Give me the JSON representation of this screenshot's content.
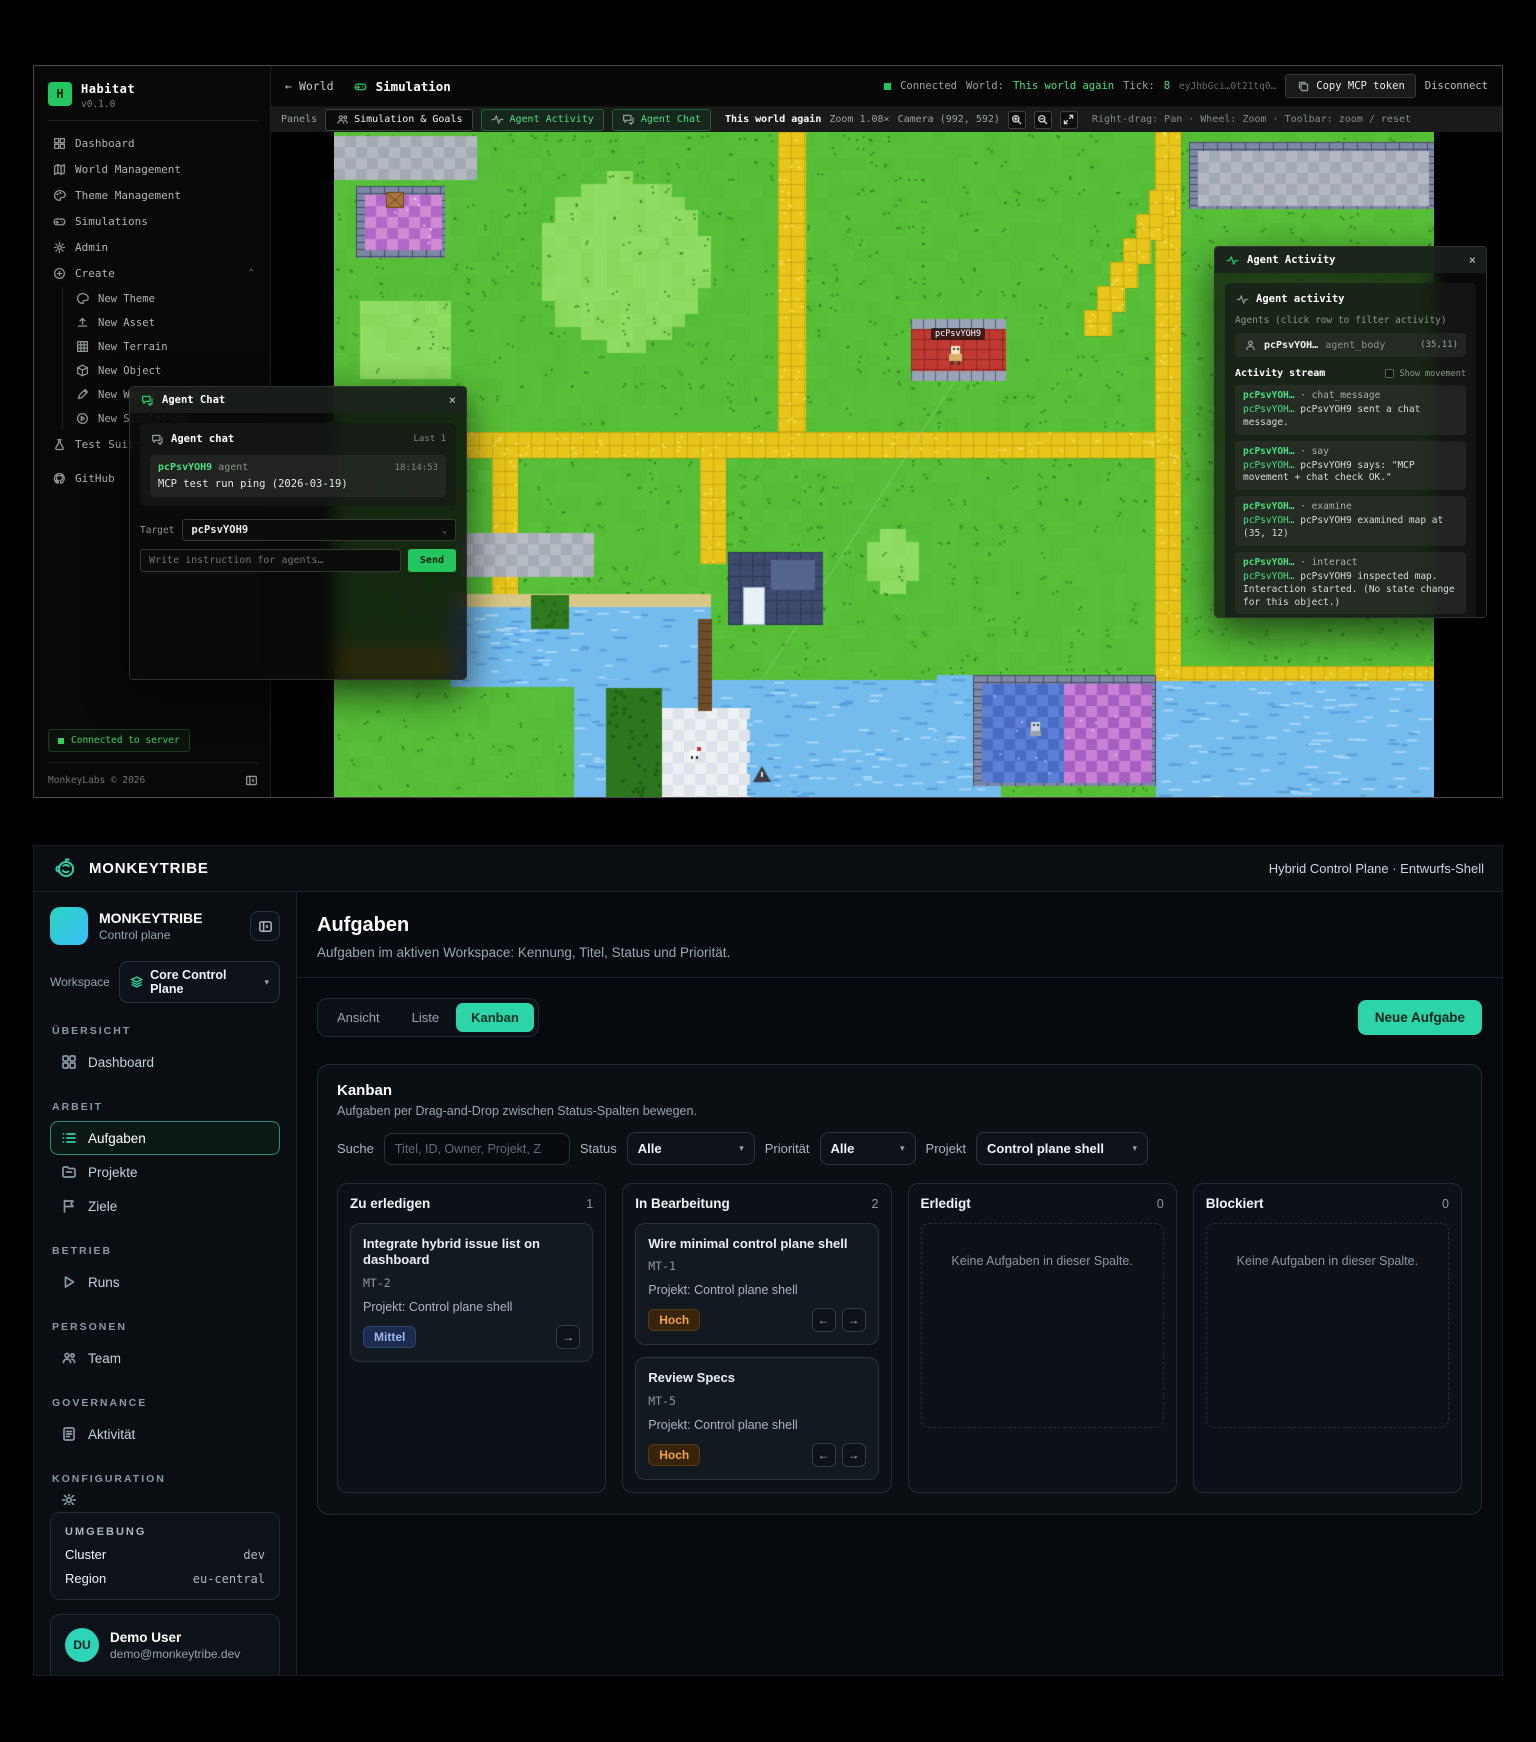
{
  "habitat": {
    "accent": "#22c55e",
    "brand": {
      "initial": "H",
      "name": "Habitat",
      "version": "v0.1.0"
    },
    "sidebar": {
      "items": [
        {
          "label": "Dashboard"
        },
        {
          "label": "World Management"
        },
        {
          "label": "Theme Management"
        },
        {
          "label": "Simulations"
        },
        {
          "label": "Admin"
        }
      ],
      "create_label": "Create",
      "create_items": [
        {
          "label": "New Theme"
        },
        {
          "label": "New Asset"
        },
        {
          "label": "New Terrain"
        },
        {
          "label": "New Object"
        },
        {
          "label": "New World (Editor)"
        },
        {
          "label": "New Simulation"
        }
      ],
      "test_suite_label": "Test Suite",
      "github_label": "GitHub",
      "connected_chip": "Connected to server",
      "footer": "MonkeyLabs © 2026"
    },
    "header": {
      "back_label": "World",
      "title": "Simulation",
      "status": "Connected",
      "world_key": "World:",
      "world_value": "This world again",
      "tick_key": "Tick:",
      "tick_value": "8",
      "token": "eyJhbGci…0t21tq0…",
      "copy_button": "Copy MCP token",
      "disconnect_button": "Disconnect"
    },
    "toolbar": {
      "panels_label": "Panels",
      "sim_goals": "Simulation & Goals",
      "agent_activity": "Agent Activity",
      "agent_chat": "Agent Chat",
      "world_name": "This world again",
      "zoom": "Zoom 1.08×",
      "camera": "Camera (992, 592)",
      "hint": "Right-drag: Pan · Wheel: Zoom · Toolbar: zoom / reset"
    },
    "map": {
      "agent_label": "pcPsvYOH9"
    },
    "chat": {
      "window_title": "Agent Chat",
      "panel_title": "Agent chat",
      "last_label": "Last 1",
      "message": {
        "author": "pcPsvYOH9",
        "role": "agent",
        "time": "18:14:53",
        "text": "MCP test run ping (2026-03-19)"
      },
      "target_label": "Target",
      "target_value": "pcPsvYOH9",
      "input_placeholder": "Write instruction for agents…",
      "send_label": "Send"
    },
    "activity": {
      "window_title": "Agent Activity",
      "panel_title": "Agent activity",
      "agents_hint": "Agents (click row to filter activity)",
      "agent_row": {
        "name": "pcPsvYOH…",
        "kind": "agent_body",
        "pos": "(35,11)"
      },
      "stream_label": "Activity stream",
      "show_movement": "Show movement",
      "entries": [
        {
          "name": "pcPsvYOH…",
          "action": "· chat_message",
          "by": "pcPsvYOH…",
          "text": "pcPsvYOH9 sent a chat message."
        },
        {
          "name": "pcPsvYOH…",
          "action": "· say",
          "by": "pcPsvYOH…",
          "text": "pcPsvYOH9 says: \"MCP movement + chat check OK.\""
        },
        {
          "name": "pcPsvYOH…",
          "action": "· examine",
          "by": "pcPsvYOH…",
          "text": "pcPsvYOH9 examined map at (35, 12)"
        },
        {
          "name": "pcPsvYOH…",
          "action": "· interact",
          "by": "pcPsvYOH…",
          "text": "pcPsvYOH9 inspected map. Interaction started. (No state change for this object.)"
        }
      ]
    }
  },
  "monkeytribe": {
    "accent": "#2dd4a8",
    "topbar": {
      "brand": "MONKEYTRIBE",
      "context": "Hybrid Control Plane · Entwurfs-Shell"
    },
    "sidebar": {
      "org_name": "MONKEYTRIBE",
      "org_sub": "Control plane",
      "workspace_label": "Workspace",
      "workspace_value": "Core Control Plane",
      "sections": {
        "uebersicht": "ÜBERSICHT",
        "arbeit": "ARBEIT",
        "betrieb": "BETRIEB",
        "personen": "PERSONEN",
        "governance": "GOVERNANCE",
        "konfiguration": "KONFIGURATION"
      },
      "nav": {
        "dashboard": "Dashboard",
        "aufgaben": "Aufgaben",
        "projekte": "Projekte",
        "ziele": "Ziele",
        "runs": "Runs",
        "team": "Team",
        "aktivitaet": "Aktivität"
      },
      "env": {
        "title": "UMGEBUNG",
        "cluster_label": "Cluster",
        "cluster_value": "dev",
        "region_label": "Region",
        "region_value": "eu-central"
      },
      "user": {
        "initials": "DU",
        "name": "Demo User",
        "email": "demo@monkeytribe.dev",
        "scheme_label": "Farbschema",
        "scheme_value": "DUNKEL"
      }
    },
    "main": {
      "title": "Aufgaben",
      "subtitle": "Aufgaben im aktiven Workspace: Kennung, Titel, Status und Priorität.",
      "view_tabs": [
        "Ansicht",
        "Liste",
        "Kanban"
      ],
      "new_task_button": "Neue Aufgabe",
      "kanban": {
        "title": "Kanban",
        "subtitle": "Aufgaben per Drag-and-Drop zwischen Status-Spalten bewegen.",
        "filters": {
          "search_label": "Suche",
          "search_placeholder": "Titel, ID, Owner, Projekt, Z",
          "status_label": "Status",
          "status_value": "Alle",
          "priority_label": "Priorität",
          "priority_value": "Alle",
          "project_label": "Projekt",
          "project_value": "Control plane shell"
        },
        "empty_text": "Keine Aufgaben in dieser Spalte.",
        "columns": [
          {
            "name": "Zu erledigen",
            "count": "1"
          },
          {
            "name": "In Bearbeitung",
            "count": "2"
          },
          {
            "name": "Erledigt",
            "count": "0"
          },
          {
            "name": "Blockiert",
            "count": "0"
          }
        ],
        "cards": [
          {
            "title": "Integrate hybrid issue list on dashboard",
            "id": "MT-2",
            "project": "Projekt: Control plane shell",
            "priority": "Mittel",
            "arrow_left": "←",
            "arrow_right": "→"
          },
          {
            "title": "Wire minimal control plane shell",
            "id": "MT-1",
            "project": "Projekt: Control plane shell",
            "priority": "Hoch",
            "arrow_left": "←",
            "arrow_right": "→"
          },
          {
            "title": "Review Specs",
            "id": "MT-5",
            "project": "Projekt: Control plane shell",
            "priority": "Hoch",
            "arrow_left": "←",
            "arrow_right": "→"
          }
        ]
      }
    }
  }
}
